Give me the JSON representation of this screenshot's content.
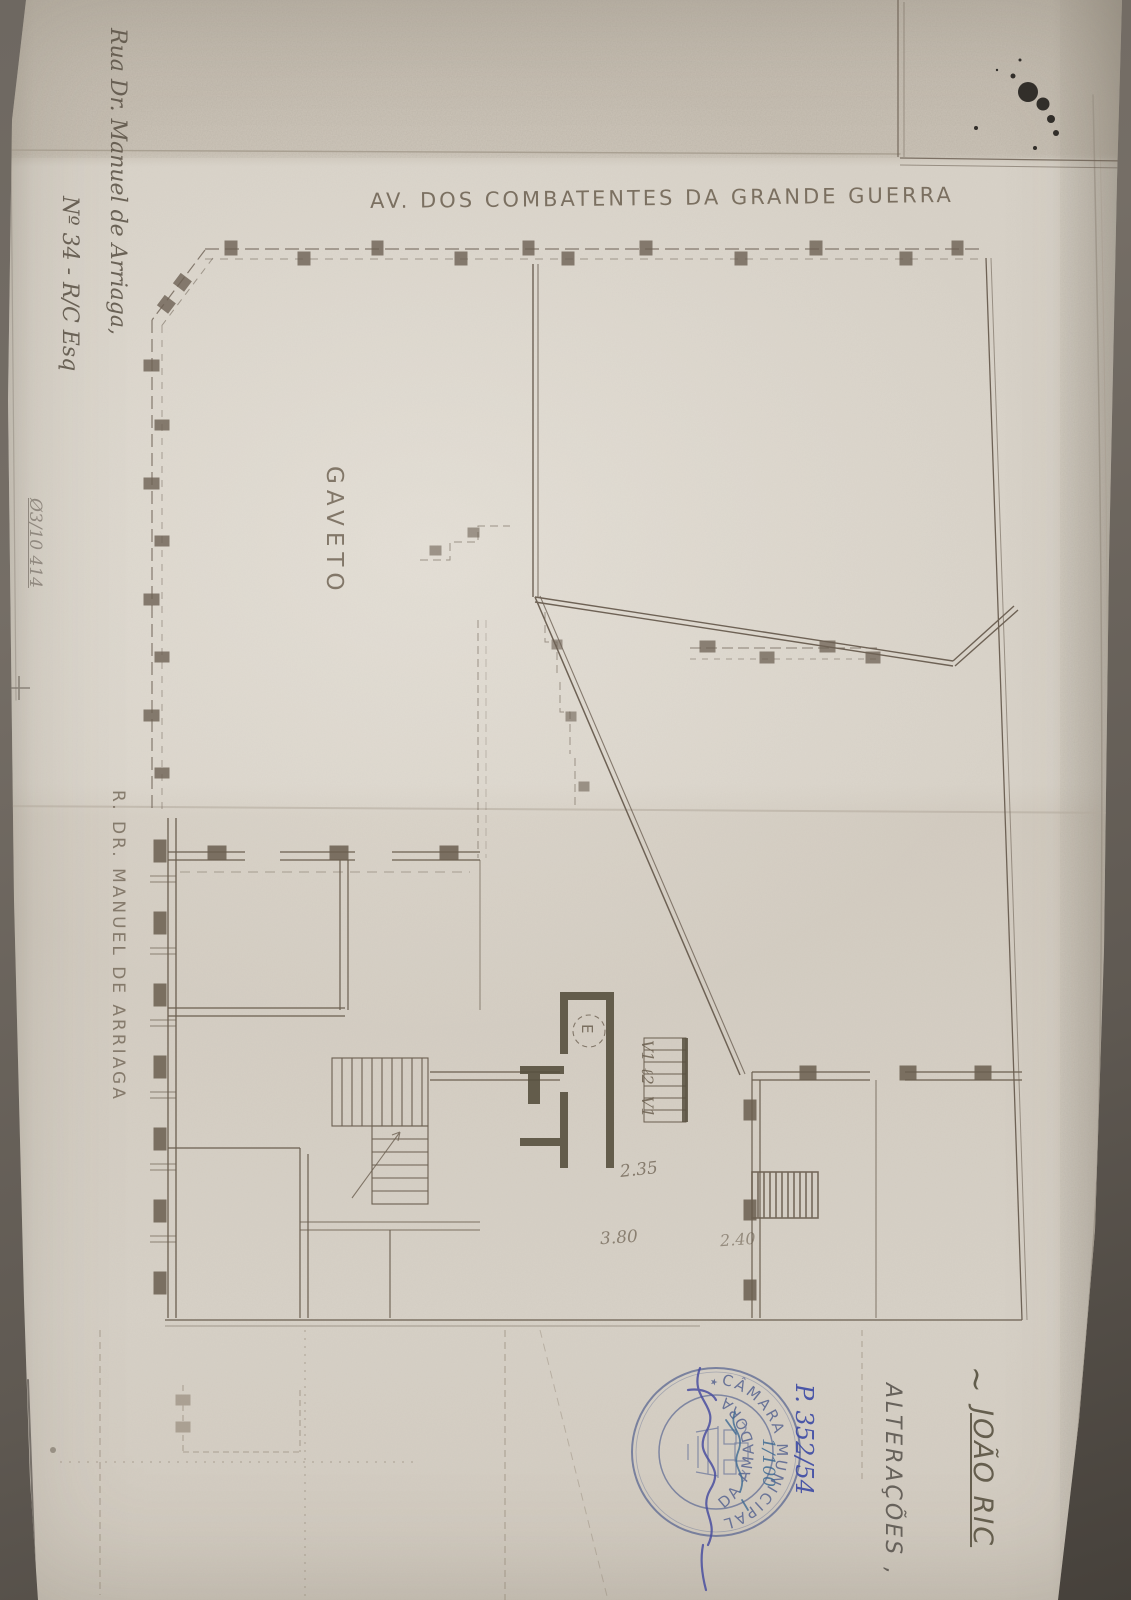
{
  "document": {
    "type_note": "scanned architectural floor plan, rotated 90deg on page",
    "street_top": "AV. DOS COMBATENTES DA GRANDE GUERRA",
    "corner_label": "GAVETO",
    "street_left": "R. DR. MANUEL DE ARRIAGA",
    "address": {
      "line1": "Rua Dr. Manuel de Arriaga,",
      "line2": "Nº 34 - R/C Esq"
    },
    "pencil_reference": "Ø3/10 414",
    "titles": {
      "tilde": "~",
      "project_name": "JOÃO RIC",
      "alteracoes": "ALTERAÇÕES ,"
    },
    "dimensions": {
      "d1": "2.35",
      "d2": "3.80",
      "d3": "2.40"
    },
    "plan_labels": {
      "v1_top": "V1",
      "l2": "ℓ2",
      "v1_bottom": "V1",
      "elevator": "E"
    },
    "stamp": {
      "ring_top": "CÂMARA MUNICIPAL",
      "ring_bottom": "DA AMADORA",
      "separator": "★"
    },
    "pen_annotations": {
      "process_number": "P. 352/54",
      "scale": "1/100"
    },
    "colors": {
      "paper": "#d8d2c8",
      "line_ink": "#6e6255",
      "pencil": "#7b736a",
      "stamp_blue": "#5e6a93",
      "pen_blue": "#3c4aa5",
      "pen_teal": "#3f6b94"
    }
  }
}
